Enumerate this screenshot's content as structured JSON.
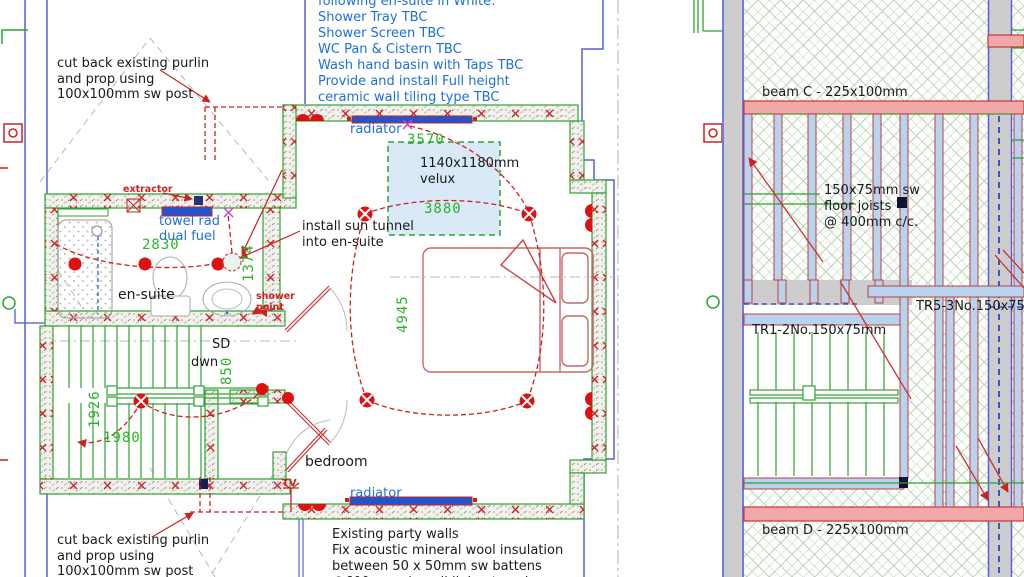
{
  "notes": {
    "spec": {
      "lines": [
        "following en-suite in White:",
        "Shower Tray TBC",
        "Shower Screen TBC",
        "WC Pan & Cistern TBC",
        "Wash hand basin with Taps TBC",
        "Provide and install Full height",
        "ceramic wall tiling type TBC"
      ]
    },
    "purlin_top": {
      "lines": [
        "cut back existing purlin",
        "and prop using",
        "100x100mm sw post"
      ]
    },
    "purlin_bottom": {
      "lines": [
        "cut back existing purlin",
        "and prop using",
        "100x100mm sw post"
      ]
    },
    "party_wall": {
      "lines": [
        "Existing party walls",
        "Fix acoustic mineral wool insulation",
        "between 50 x 50mm sw battens",
        "@600mm c/c wall lining type b"
      ]
    },
    "sun_tunnel": {
      "lines": [
        "install sun tunnel",
        "into en-suite"
      ]
    },
    "velux": {
      "lines": [
        "1140x1180mm",
        "velux"
      ]
    },
    "floor_joists": {
      "lines": [
        "150x75mm sw",
        "floor joists",
        "@ 400mm c/c."
      ]
    }
  },
  "labels": {
    "radiator_top": "radiator",
    "radiator_bottom": "radiator",
    "towel_rad": "towel rad",
    "dual_fuel": "dual fuel",
    "extractor": "extractor",
    "shower": "shower",
    "point": "point",
    "en_suite": "en-suite",
    "bedroom": "bedroom",
    "sd": "SD",
    "dwn": "dwn",
    "tv": "TV",
    "beam_c": "beam C - 225x100mm",
    "beam_d": "beam D - 225x100mm",
    "tr1": "TR1-2No.150x75mm",
    "tr5": "TR5-3No.150x75mm"
  },
  "dims": {
    "w3570": "3570",
    "w3880": "3880",
    "w2830": "2830",
    "h1374": "1374",
    "h4945": "4945",
    "h1926": "1926",
    "w1980": "1980",
    "h850": "850"
  },
  "colors": {
    "annotation_blue": "#1f6fe0",
    "dimension_green": "#28b428",
    "electrical_red": "#cc2222",
    "wall_green": "#2fa32f",
    "beam_pink": "#f0a8a8",
    "joist_blue": "#b9d2ee",
    "existing_wall_gray": "#cdcdcd",
    "velux_fill": "#d9e9f8"
  }
}
